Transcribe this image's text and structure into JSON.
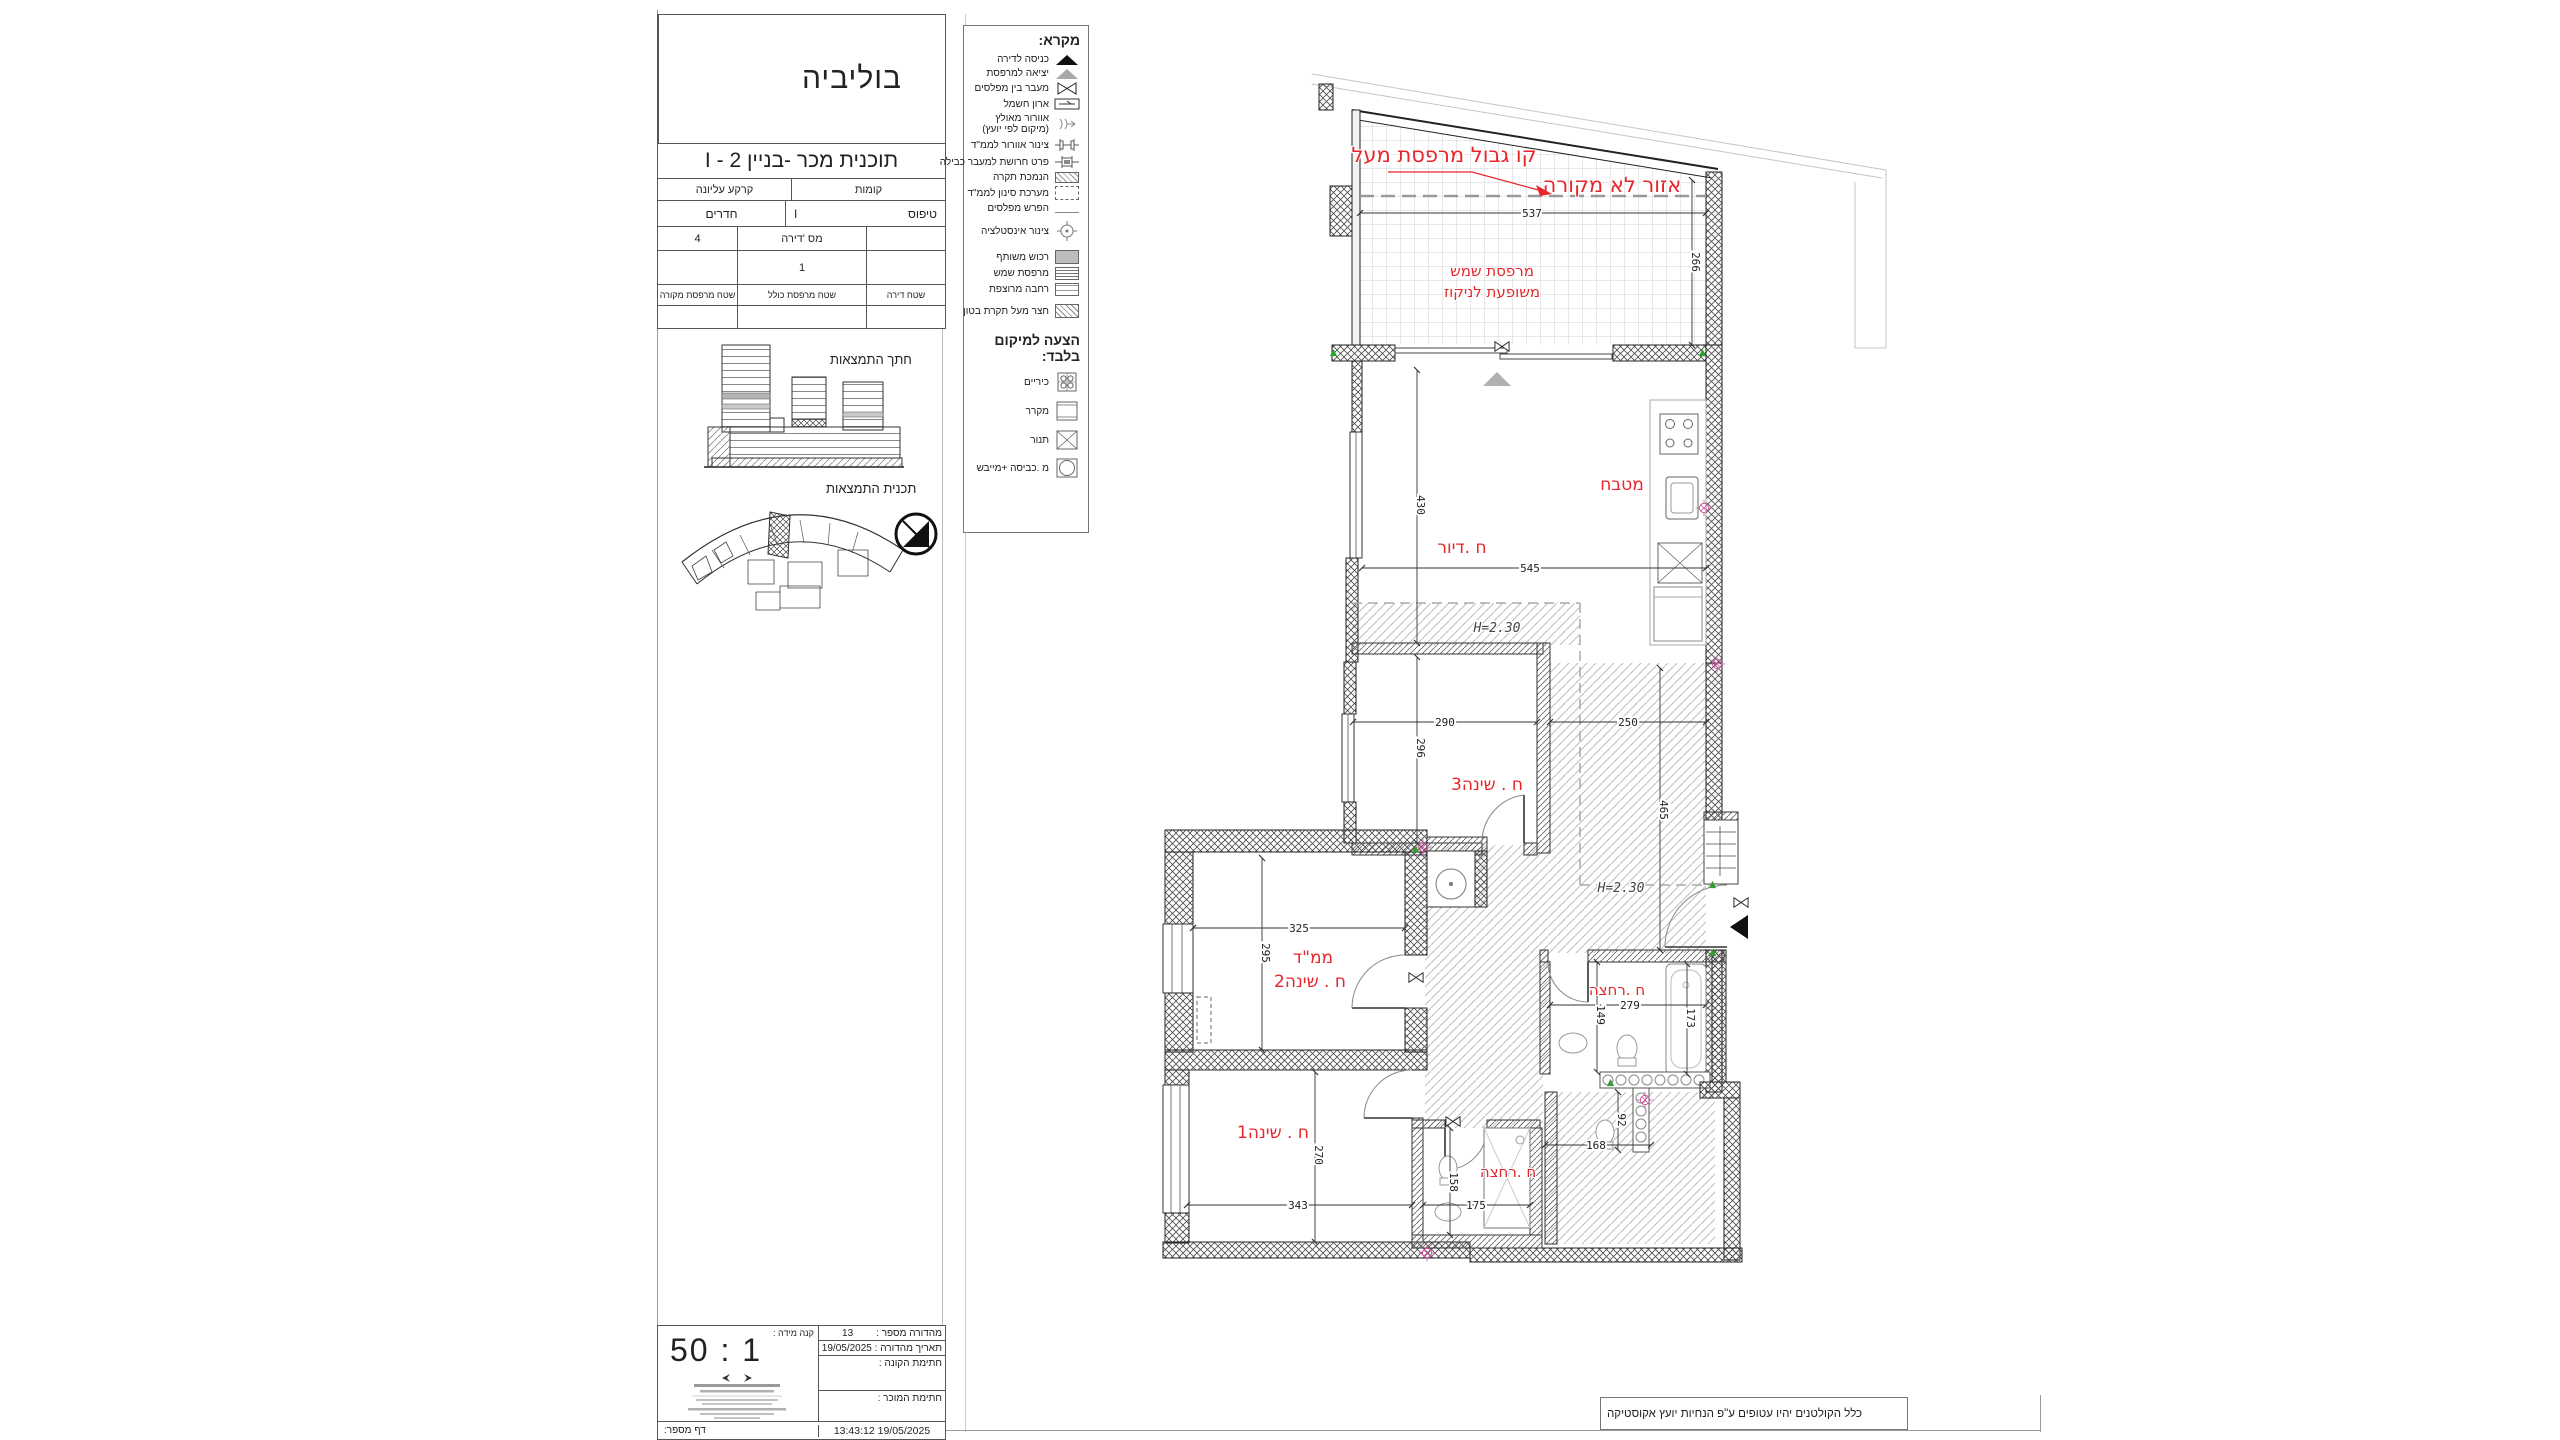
{
  "sheet": {
    "project_name": "בוליביה",
    "plan_title": "תוכנית מכר -בניין 2 - I",
    "info_table": {
      "floors_label": "קומות",
      "floors_value": "קרקע עליונה",
      "type_label": "טיפוס",
      "type_value": "I",
      "rooms_label": "חדרים",
      "rooms_value": "4",
      "apt_label": "מס 'דירה",
      "apt_value": "1",
      "area_apt_label": "שטח דירה",
      "area_balcony_label": "שטח מרפסת כולל",
      "area_covered_label": "שטח מרפסת מקורה"
    },
    "section_title": "חתך התמצאות",
    "siteplan_title": "תכנית התמצאות"
  },
  "legend": {
    "title": "מקרא:",
    "items": [
      {
        "label": "כניסה לדירה",
        "icon": "entrance-arrow"
      },
      {
        "label": "יציאה למרפסת",
        "icon": "balcony-exit-arrow"
      },
      {
        "label": "מעבר בין מפלסים",
        "icon": "level-passage"
      },
      {
        "label": "ארון חשמל",
        "icon": "electric-cabinet"
      },
      {
        "label": "אוורור מאולץ",
        "label2": "(מיקום לפי יועץ)",
        "icon": "forced-vent"
      },
      {
        "label": "צינור אוורור לממ\"ד",
        "icon": "mamad-vent-pipe"
      },
      {
        "label": "פרט חרושת למעבר כבילה",
        "icon": "cable-pass-detail"
      },
      {
        "label": "הנמכת תקרה",
        "icon": "lowered-ceiling-hatch"
      },
      {
        "label": "מערכת סינון לממ\"ד",
        "icon": "mamad-filter-system"
      },
      {
        "label": "הפרש מפלסים",
        "icon": "level-difference"
      },
      {
        "label": "צינור אינסטלציה",
        "icon": "plumbing-pipe"
      },
      {
        "label": "רכוש משותף",
        "icon": "shared-property"
      },
      {
        "label": "מרפסת שמש",
        "icon": "sun-balcony-hatch"
      },
      {
        "label": "רחבה מרוצפת",
        "icon": "paved-area-hatch"
      },
      {
        "label": "חצר מעל תקרת בטון",
        "icon": "yard-over-concrete-hatch"
      }
    ],
    "suggestion_title": "הצעה למיקום בלבד:",
    "suggestion_items": [
      {
        "label": "כיריים",
        "icon": "cooktop"
      },
      {
        "label": "מקרר",
        "icon": "fridge"
      },
      {
        "label": "תנור",
        "icon": "oven"
      },
      {
        "label": "מ .כביסה +מייבש",
        "icon": "washer-dryer"
      }
    ]
  },
  "plan": {
    "rooms": {
      "kitchen": "מטבח",
      "living": "ח .דיור",
      "bed3": "ח . שינה3",
      "mamad": "ממ\"ד",
      "bed2": "ח . שינה2",
      "bed1": "ח . שינה1",
      "bath1": "ח .רחצה",
      "bath2": "ח .רחצה"
    },
    "notes": {
      "balcony_boundary": "קו גבול מרפסת מעל",
      "uncovered": "אזור לא מקורה",
      "sun_balcony_1": "מרפסת שמש",
      "sun_balcony_2": "משופעת לניקוז"
    },
    "height_label": "H=2.30",
    "dims": {
      "balcony_width": "537",
      "balcony_depth": "266",
      "living_height": "430",
      "living_width": "545",
      "bed3_width": "290",
      "bed3_height": "296",
      "corridor_width": "250",
      "corridor_height": "465",
      "mamad_width": "325",
      "mamad_height": "295",
      "bed1_width": "343",
      "bed1_height": "270",
      "bath1_width": "279",
      "bath1_left": "149",
      "bath1_right": "173",
      "bath2_height": "158",
      "bath2_width": "175",
      "service_height": "92",
      "service_width": "168"
    }
  },
  "footer": {
    "scale_label": "קנה מידה :",
    "scale_value": "1 : 50",
    "edition_label": "מהדורה מספר :",
    "edition_value": "13",
    "edition_date_label": "תאריך מהדורה :",
    "edition_date_value": "19/05/2025",
    "buyer_sign_label": "חתימת הקונה :",
    "seller_sign_label": "חתימת המוכר :",
    "page_label": "דף מספר:",
    "timestamp": "19/05/2025 13:43:12",
    "note": "כלל הקולטנים יהיו עטופים ע\"פ הנחיות יועץ אקוסטיקה"
  }
}
